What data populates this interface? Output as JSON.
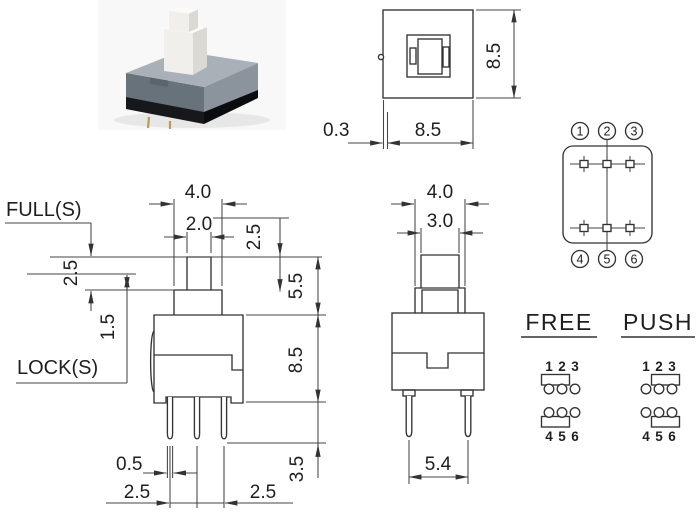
{
  "palette": {
    "line": "#3f3f3f",
    "text": "#1e1e1e",
    "photo": {
      "backdrop": "#f8f8f8",
      "shadow": "#e7e7e7",
      "plunger_front": "#f0efeb",
      "plunger_side": "#dbd9d3",
      "plunger_top": "#fbfaf7",
      "housing_top": "#a9b0b8",
      "housing_front": "#68727a",
      "housing_side": "#8b939c",
      "notch": "#5a646c",
      "base_front": "#17181c",
      "base_side": "#0b0c0f",
      "pin": "#bb9b50"
    }
  },
  "top_view": {
    "dim_height": "8.5",
    "dim_offset": "0.3",
    "dim_width": "8.5"
  },
  "pin_diagram": {
    "pins_top": [
      "1",
      "2",
      "3"
    ],
    "pins_bottom": [
      "4",
      "5",
      "6"
    ]
  },
  "front_view": {
    "label_full": "FULL(S)",
    "label_lock": "LOCK(S)",
    "dim_cap_width": "4.0",
    "dim_stem_width": "2.0",
    "dim_travel": "2.5",
    "dim_lock_travel": "1.5",
    "dim_stem_height": "2.5",
    "dim_plunger_height": "5.5",
    "dim_body_height": "8.5",
    "dim_pin_width": "0.5",
    "dim_pitch_left": "2.5",
    "dim_pitch_right": "2.5",
    "dim_pin_length": "3.5"
  },
  "side_view": {
    "dim_cap_width": "4.0",
    "dim_stem_width": "3.0",
    "dim_pin_span": "5.4"
  },
  "states": {
    "free": {
      "title": "FREE",
      "pins_top": [
        "1",
        "2",
        "3"
      ],
      "pins_bottom": [
        "4",
        "5",
        "6"
      ]
    },
    "push": {
      "title": "PUSH",
      "pins_top": [
        "1",
        "2",
        "3"
      ],
      "pins_bottom": [
        "4",
        "5",
        "6"
      ]
    }
  }
}
